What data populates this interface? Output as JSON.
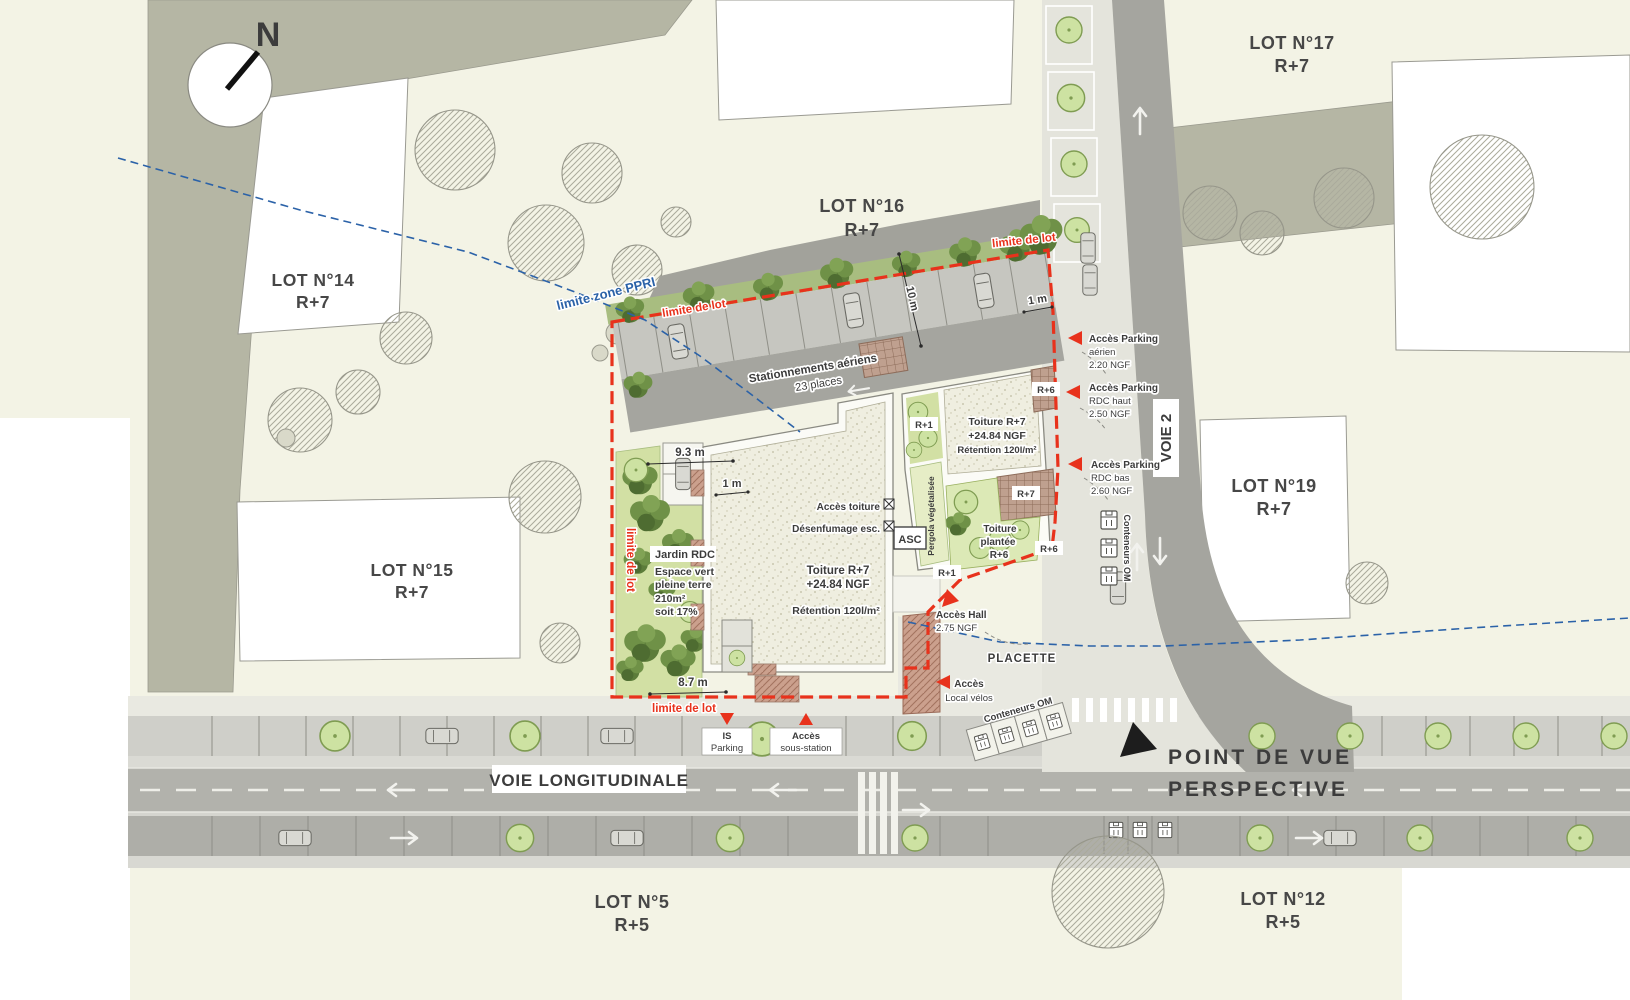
{
  "compass": {
    "n": "N"
  },
  "lots": {
    "l14": {
      "t": "LOT N°14",
      "f": "R+7"
    },
    "l15": {
      "t": "LOT N°15",
      "f": "R+7"
    },
    "l16": {
      "t": "LOT N°16",
      "f": "R+7"
    },
    "l17": {
      "t": "LOT N°17",
      "f": "R+7"
    },
    "l19": {
      "t": "LOT N°19",
      "f": "R+7"
    },
    "l5": {
      "t": "LOT N°5",
      "f": "R+5"
    },
    "l12": {
      "t": "LOT N°12",
      "f": "R+5"
    }
  },
  "roads": {
    "voie2": "VOIE 2",
    "longitudinale": "VOIE LONGITUDINALE"
  },
  "viewpoint": {
    "line1": "POINT DE VUE",
    "line2": "PERSPECTIVE"
  },
  "limits": {
    "ppri": "limite zone PPRI",
    "top": "limite de lot",
    "topright": "limite de lot",
    "west": "limite de lot",
    "bottom": "limite de lot"
  },
  "parking": {
    "line1": "Stationnements aériens",
    "line2": "23 places"
  },
  "dims": {
    "w93": "9.3 m",
    "w1": "1 m",
    "n10": "10 m",
    "n1": "1 m",
    "s87": "8.7 m"
  },
  "roof_main": {
    "l1": "Toiture R+7",
    "l2": "+24.84 NGF",
    "l3": "Rétention 120l/m²"
  },
  "roof_east": {
    "l1": "Toiture R+7",
    "l2": "+24.84 NGF",
    "l3": "Rétention 120l/m²"
  },
  "green_roof": {
    "l1": "Toiture",
    "l2": "plantée",
    "l3": "R+6"
  },
  "garden": {
    "l1": "Jardin RDC",
    "l2": "Espace vert",
    "l3": "pleine terre",
    "l4": "210m²",
    "l5": "soit 17%"
  },
  "tech": {
    "toiture": "Accès toiture",
    "desenfumage": "Désenfumage esc.",
    "asc": "ASC",
    "pergola": "Pergola végétalisée"
  },
  "levels": {
    "r1a": "R+1",
    "r1b": "R+1",
    "r6a": "R+6",
    "r6b": "R+6",
    "r7a": "R+7"
  },
  "access": {
    "aerien": {
      "l1": "Accès Parking",
      "l2": "aérien",
      "l3": "2.20 NGF"
    },
    "rdchaut": {
      "l1": "Accès Parking",
      "l2": "RDC haut",
      "l3": "2.50 NGF"
    },
    "rdcbas": {
      "l1": "Accès Parking",
      "l2": "RDC bas",
      "l3": "2.60 NGF"
    },
    "hall": {
      "l1": "Accès Hall",
      "l2": "2.75 NGF"
    },
    "velos": {
      "l1": "Accès",
      "l2": "Local vélos"
    },
    "is": {
      "l1": "IS",
      "l2": "Parking"
    },
    "sousstation": {
      "l1": "Accès",
      "l2": "sous-station"
    }
  },
  "misc": {
    "placette": "PLACETTE",
    "conteneurs_voie": "Conteneurs OM",
    "conteneurs_placette": "Conteneurs OM"
  },
  "colors": {
    "cream": "#f3f3e5",
    "sage": "#b5b6a4",
    "red": "#e8321c",
    "blue": "#2b62a8",
    "road_dark": "#a9a9a3",
    "green": "#d2e0a4"
  }
}
